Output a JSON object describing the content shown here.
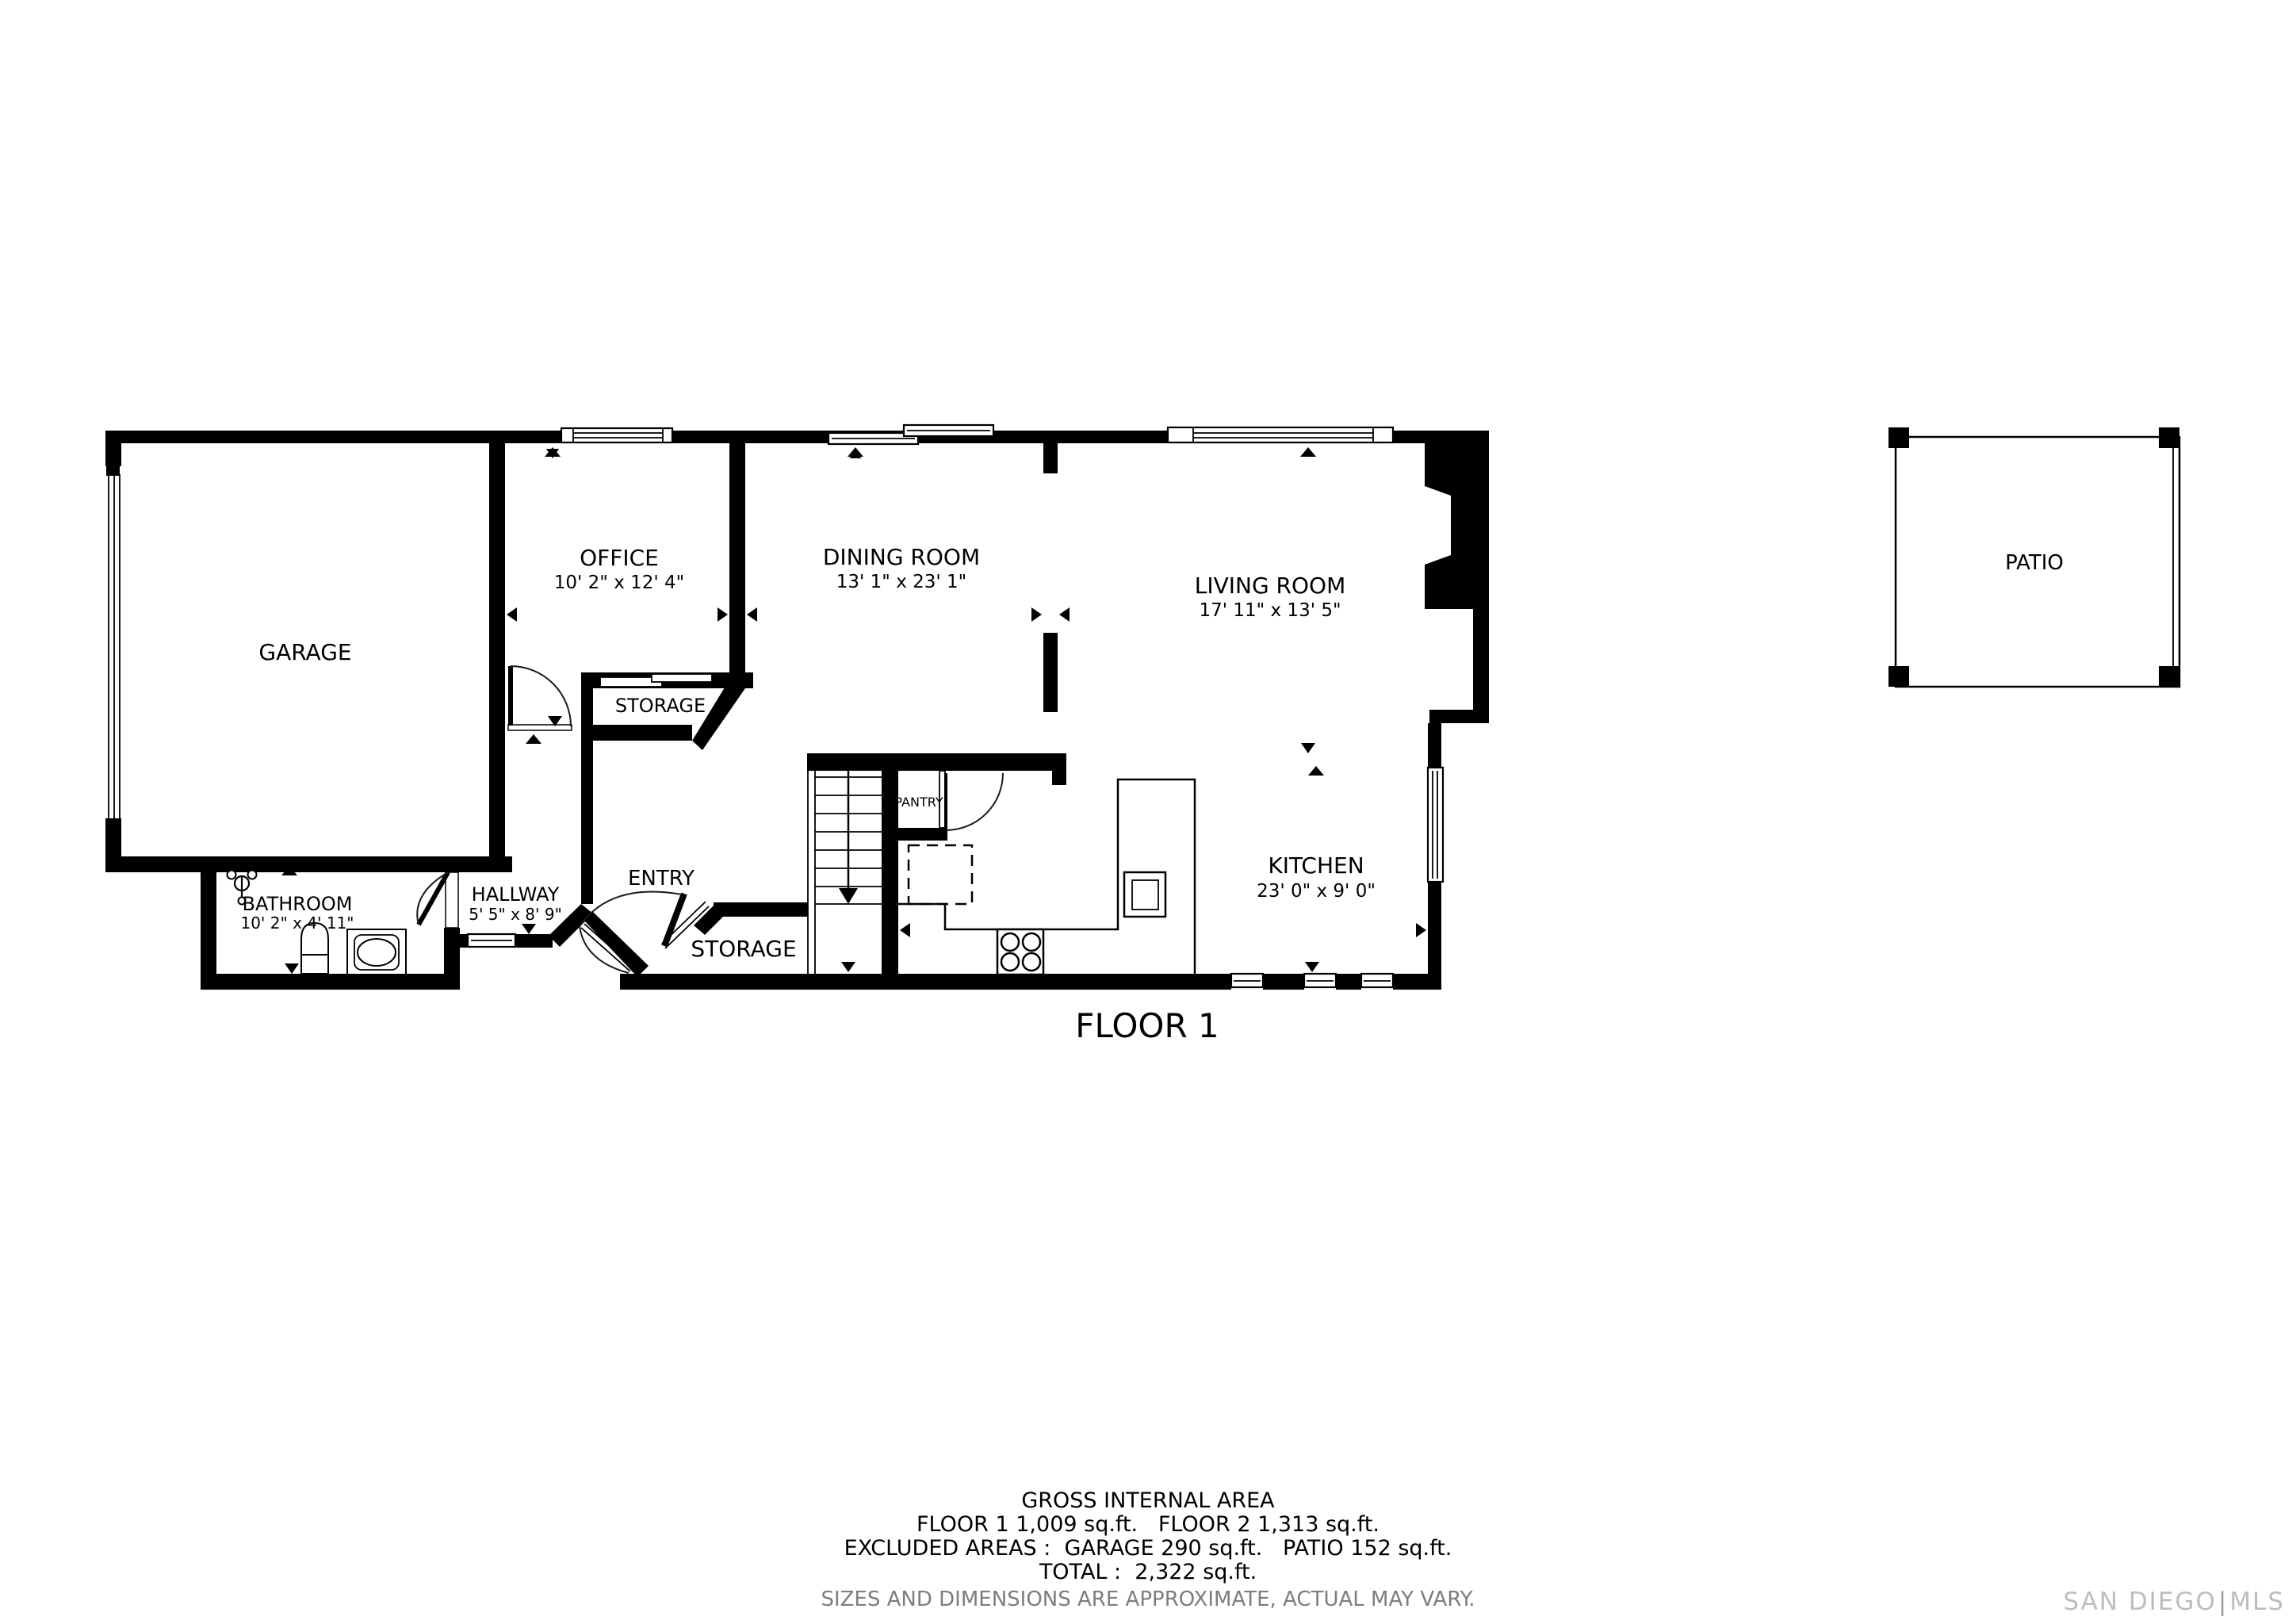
{
  "floor_title": "FLOOR 1",
  "rooms": {
    "garage": {
      "name": "GARAGE",
      "dims": ""
    },
    "office": {
      "name": "OFFICE",
      "dims": "10' 2\" x 12' 4\""
    },
    "dining": {
      "name": "DINING ROOM",
      "dims": "13' 1\" x 23' 1\""
    },
    "living": {
      "name": "LIVING ROOM",
      "dims": "17' 11\" x 13' 5\""
    },
    "storage_upper": {
      "name": "STORAGE",
      "dims": ""
    },
    "entry": {
      "name": "ENTRY",
      "dims": ""
    },
    "storage_lower": {
      "name": "STORAGE",
      "dims": ""
    },
    "hallway": {
      "name": "HALLWAY",
      "dims": "5' 5\" x 8' 9\""
    },
    "bathroom": {
      "name": "BATHROOM",
      "dims": "10' 2\" x 4' 11\""
    },
    "kitchen": {
      "name": "KITCHEN",
      "dims": "23' 0\" x 9' 0\""
    },
    "pantry": {
      "name": "PANTRY",
      "dims": ""
    },
    "patio": {
      "name": "PATIO",
      "dims": ""
    }
  },
  "area_summary": {
    "lines": [
      "GROSS INTERNAL AREA",
      "FLOOR 1 1,009 sq.ft.   FLOOR 2 1,313 sq.ft.",
      "EXCLUDED AREAS :  GARAGE 290 sq.ft.   PATIO 152 sq.ft.",
      "TOTAL :  2,322 sq.ft."
    ],
    "disclaimer": "SIZES AND DIMENSIONS ARE APPROXIMATE, ACTUAL MAY VARY."
  },
  "watermark": {
    "left": "SAN DIEGO",
    "right": "MLS"
  },
  "colors": {
    "walls": "#000000",
    "disclaimer_gray": "#7d7d7d",
    "watermark_gray": "#bdbdbd"
  }
}
